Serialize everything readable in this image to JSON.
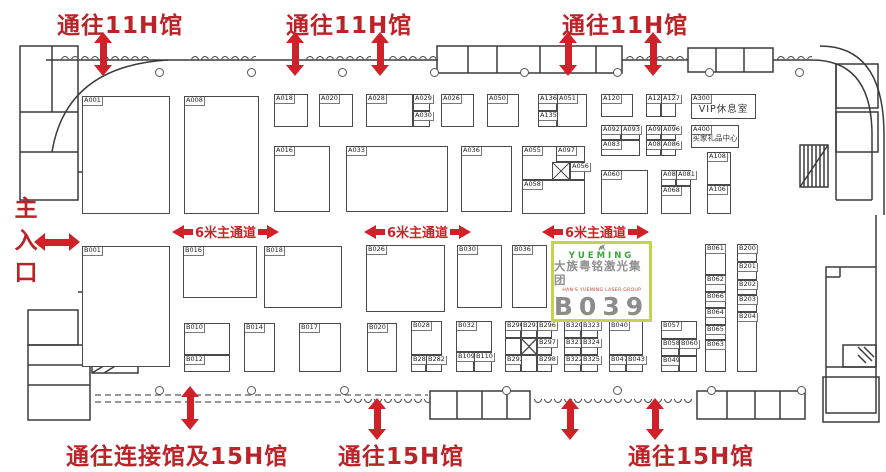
{
  "legend": {
    "top_exits": [
      "通往11H馆",
      "通往11H馆",
      "通往11H馆"
    ],
    "bottom_exits": [
      "通往连接馆及15H馆",
      "通往15H馆",
      "通往15H馆"
    ],
    "main_entrance": "主入口",
    "aisle_label": "6米主通道"
  },
  "special_rooms": {
    "vip": {
      "code": "A300",
      "name": "VIP休息室"
    },
    "gift": {
      "code": "A400",
      "name": "买家礼品中心"
    }
  },
  "highlight_booth": {
    "id": "B039",
    "brand_en": "YUEMING",
    "brand_cn": "大族粤铭激光集团",
    "brand_sub": "HAN'S YUEMING LASER GROUP",
    "registered": "®"
  },
  "colors": {
    "accent_red": "#bb2328",
    "arrow_red": "#d02128",
    "highlight_border": "#c5d24f",
    "logo_green": "#4aa93c",
    "logo_gray": "#757575",
    "booth_line": "#4a4a4a"
  },
  "icons": {
    "exit_arrow": "red-double-headed-arrow",
    "entrance_arrow": "red-double-headed-arrow-horizontal",
    "aisle_arrows": "red-left-right-arrows",
    "yueming_logo": "green-swoosh-over-gray-M"
  },
  "booths": [
    {
      "id": "A001",
      "x": 82,
      "y": 96,
      "w": 88,
      "h": 118
    },
    {
      "id": "A008",
      "x": 184,
      "y": 96,
      "w": 75,
      "h": 118
    },
    {
      "id": "A018",
      "x": 274,
      "y": 94,
      "w": 34,
      "h": 33
    },
    {
      "id": "A020",
      "x": 319,
      "y": 94,
      "w": 34,
      "h": 33
    },
    {
      "id": "A028",
      "x": 366,
      "y": 94,
      "w": 47,
      "h": 33
    },
    {
      "id": "A029",
      "x": 413,
      "y": 94,
      "w": 17,
      "h": 17
    },
    {
      "id": "A030",
      "x": 413,
      "y": 111,
      "w": 17,
      "h": 16
    },
    {
      "id": "A026",
      "x": 441,
      "y": 94,
      "w": 33,
      "h": 33
    },
    {
      "id": "A050",
      "x": 487,
      "y": 94,
      "w": 32,
      "h": 33
    },
    {
      "id": "A136",
      "x": 538,
      "y": 94,
      "w": 19,
      "h": 17
    },
    {
      "id": "A135",
      "x": 538,
      "y": 111,
      "w": 19,
      "h": 16
    },
    {
      "id": "A051",
      "x": 557,
      "y": 94,
      "w": 30,
      "h": 33
    },
    {
      "id": "A120",
      "x": 601,
      "y": 94,
      "w": 32,
      "h": 23
    },
    {
      "id": "A122",
      "x": 646,
      "y": 94,
      "w": 15,
      "h": 23
    },
    {
      "id": "A127",
      "x": 661,
      "y": 94,
      "w": 15,
      "h": 23
    },
    {
      "id": "A092",
      "x": 601,
      "y": 125,
      "w": 20,
      "h": 15
    },
    {
      "id": "A093",
      "x": 621,
      "y": 125,
      "w": 19,
      "h": 15
    },
    {
      "id": "A083",
      "x": 601,
      "y": 140,
      "w": 39,
      "h": 16
    },
    {
      "id": "A095",
      "x": 646,
      "y": 125,
      "w": 15,
      "h": 15
    },
    {
      "id": "A096",
      "x": 661,
      "y": 125,
      "w": 15,
      "h": 15
    },
    {
      "id": "A085",
      "x": 646,
      "y": 140,
      "w": 15,
      "h": 16
    },
    {
      "id": "A086",
      "x": 661,
      "y": 140,
      "w": 15,
      "h": 16
    },
    {
      "id": "A016",
      "x": 274,
      "y": 146,
      "w": 56,
      "h": 66
    },
    {
      "id": "A033",
      "x": 346,
      "y": 146,
      "w": 102,
      "h": 66
    },
    {
      "id": "A036",
      "x": 461,
      "y": 146,
      "w": 51,
      "h": 66
    },
    {
      "id": "A055",
      "x": 522,
      "y": 146,
      "w": 63,
      "h": 34
    },
    {
      "id": "A097",
      "x": 556,
      "y": 146,
      "w": 29,
      "h": 16
    },
    {
      "id": "",
      "x": 552,
      "y": 162,
      "w": 18,
      "h": 18,
      "cross": true
    },
    {
      "id": "A056",
      "x": 570,
      "y": 162,
      "w": 15,
      "h": 18
    },
    {
      "id": "A058",
      "x": 522,
      "y": 180,
      "w": 63,
      "h": 34
    },
    {
      "id": "A060",
      "x": 601,
      "y": 170,
      "w": 47,
      "h": 44
    },
    {
      "id": "A080",
      "x": 661,
      "y": 170,
      "w": 15,
      "h": 16
    },
    {
      "id": "A081",
      "x": 676,
      "y": 170,
      "w": 15,
      "h": 16
    },
    {
      "id": "A068",
      "x": 661,
      "y": 186,
      "w": 30,
      "h": 28
    },
    {
      "id": "A108",
      "x": 707,
      "y": 152,
      "w": 24,
      "h": 33
    },
    {
      "id": "A106",
      "x": 707,
      "y": 185,
      "w": 24,
      "h": 29
    },
    {
      "id": "B001",
      "x": 82,
      "y": 246,
      "w": 88,
      "h": 121
    },
    {
      "id": "B016",
      "x": 183,
      "y": 246,
      "w": 74,
      "h": 52
    },
    {
      "id": "B018",
      "x": 264,
      "y": 246,
      "w": 78,
      "h": 62
    },
    {
      "id": "B026",
      "x": 366,
      "y": 245,
      "w": 79,
      "h": 67
    },
    {
      "id": "B030",
      "x": 457,
      "y": 245,
      "w": 45,
      "h": 63
    },
    {
      "id": "B036",
      "x": 512,
      "y": 245,
      "w": 35,
      "h": 63
    },
    {
      "id": "B010",
      "x": 184,
      "y": 323,
      "w": 46,
      "h": 32
    },
    {
      "id": "B012",
      "x": 184,
      "y": 355,
      "w": 46,
      "h": 17
    },
    {
      "id": "B014",
      "x": 244,
      "y": 323,
      "w": 31,
      "h": 49
    },
    {
      "id": "B017",
      "x": 299,
      "y": 323,
      "w": 42,
      "h": 49
    },
    {
      "id": "B020",
      "x": 367,
      "y": 323,
      "w": 30,
      "h": 49
    },
    {
      "id": "B028",
      "x": 411,
      "y": 321,
      "w": 31,
      "h": 34
    },
    {
      "id": "B281",
      "x": 411,
      "y": 355,
      "w": 15,
      "h": 17
    },
    {
      "id": "B282",
      "x": 426,
      "y": 355,
      "w": 16,
      "h": 17
    },
    {
      "id": "B032",
      "x": 456,
      "y": 321,
      "w": 36,
      "h": 31
    },
    {
      "id": "B109",
      "x": 456,
      "y": 352,
      "w": 18,
      "h": 20
    },
    {
      "id": "B110",
      "x": 474,
      "y": 352,
      "w": 18,
      "h": 20
    },
    {
      "id": "B290",
      "x": 505,
      "y": 321,
      "w": 16,
      "h": 17
    },
    {
      "id": "B293",
      "x": 521,
      "y": 321,
      "w": 16,
      "h": 17
    },
    {
      "id": "B296",
      "x": 537,
      "y": 321,
      "w": 15,
      "h": 17
    },
    {
      "id": "",
      "x": 505,
      "y": 338,
      "w": 16,
      "h": 17
    },
    {
      "id": "",
      "x": 521,
      "y": 338,
      "w": 16,
      "h": 17,
      "cross": true
    },
    {
      "id": "B297",
      "x": 537,
      "y": 338,
      "w": 15,
      "h": 17
    },
    {
      "id": "B292",
      "x": 505,
      "y": 355,
      "w": 16,
      "h": 17
    },
    {
      "id": "",
      "x": 521,
      "y": 355,
      "w": 16,
      "h": 17
    },
    {
      "id": "B298",
      "x": 537,
      "y": 355,
      "w": 15,
      "h": 17
    },
    {
      "id": "B320",
      "x": 564,
      "y": 321,
      "w": 17,
      "h": 17
    },
    {
      "id": "B323",
      "x": 581,
      "y": 321,
      "w": 17,
      "h": 17
    },
    {
      "id": "B321",
      "x": 564,
      "y": 338,
      "w": 17,
      "h": 17
    },
    {
      "id": "B324",
      "x": 581,
      "y": 338,
      "w": 17,
      "h": 17
    },
    {
      "id": "B322",
      "x": 564,
      "y": 355,
      "w": 17,
      "h": 17
    },
    {
      "id": "B325",
      "x": 581,
      "y": 355,
      "w": 17,
      "h": 17
    },
    {
      "id": "B040",
      "x": 609,
      "y": 321,
      "w": 34,
      "h": 34
    },
    {
      "id": "B047",
      "x": 609,
      "y": 355,
      "w": 17,
      "h": 17
    },
    {
      "id": "B043",
      "x": 626,
      "y": 355,
      "w": 17,
      "h": 17
    },
    {
      "id": "B057",
      "x": 661,
      "y": 321,
      "w": 36,
      "h": 18
    },
    {
      "id": "B058",
      "x": 661,
      "y": 339,
      "w": 18,
      "h": 17
    },
    {
      "id": "B060",
      "x": 679,
      "y": 339,
      "w": 18,
      "h": 17
    },
    {
      "id": "B049",
      "x": 661,
      "y": 356,
      "w": 18,
      "h": 16
    },
    {
      "id": "",
      "x": 679,
      "y": 356,
      "w": 18,
      "h": 16
    },
    {
      "id": "B061",
      "x": 705,
      "y": 244,
      "w": 21,
      "h": 31
    },
    {
      "id": "B062",
      "x": 705,
      "y": 275,
      "w": 21,
      "h": 17
    },
    {
      "id": "B066",
      "x": 705,
      "y": 292,
      "w": 21,
      "h": 16
    },
    {
      "id": "B064",
      "x": 705,
      "y": 308,
      "w": 21,
      "h": 17
    },
    {
      "id": "B065",
      "x": 705,
      "y": 325,
      "w": 21,
      "h": 15
    },
    {
      "id": "B063",
      "x": 705,
      "y": 340,
      "w": 21,
      "h": 32
    },
    {
      "id": "B200",
      "x": 737,
      "y": 244,
      "w": 20,
      "h": 18
    },
    {
      "id": "B201",
      "x": 737,
      "y": 262,
      "w": 20,
      "h": 18
    },
    {
      "id": "B202",
      "x": 737,
      "y": 280,
      "w": 20,
      "h": 15
    },
    {
      "id": "B203",
      "x": 737,
      "y": 295,
      "w": 20,
      "h": 17
    },
    {
      "id": "B204",
      "x": 737,
      "y": 312,
      "w": 20,
      "h": 60
    }
  ]
}
